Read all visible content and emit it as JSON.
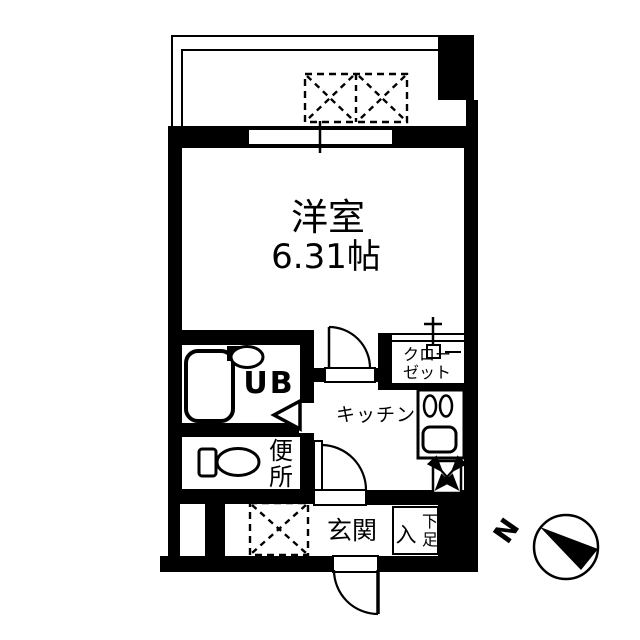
{
  "floorplan": {
    "rooms": {
      "main_room": {
        "label": "洋室",
        "size": "6.31帖"
      },
      "unit_bath": {
        "label": "UB"
      },
      "toilet": {
        "char1": "便",
        "char2": "所"
      },
      "kitchen": {
        "label": "キッチン"
      },
      "closet": {
        "line1": "クロー",
        "line2": "ゼット"
      },
      "entrance": {
        "label": "玄関"
      },
      "shoe_cabinet": {
        "char_in": "入",
        "char_top": "下",
        "char_bottom": "足"
      }
    },
    "compass": {
      "north_label": "N"
    },
    "colors": {
      "wall": "#000000",
      "floor": "#ffffff"
    }
  }
}
